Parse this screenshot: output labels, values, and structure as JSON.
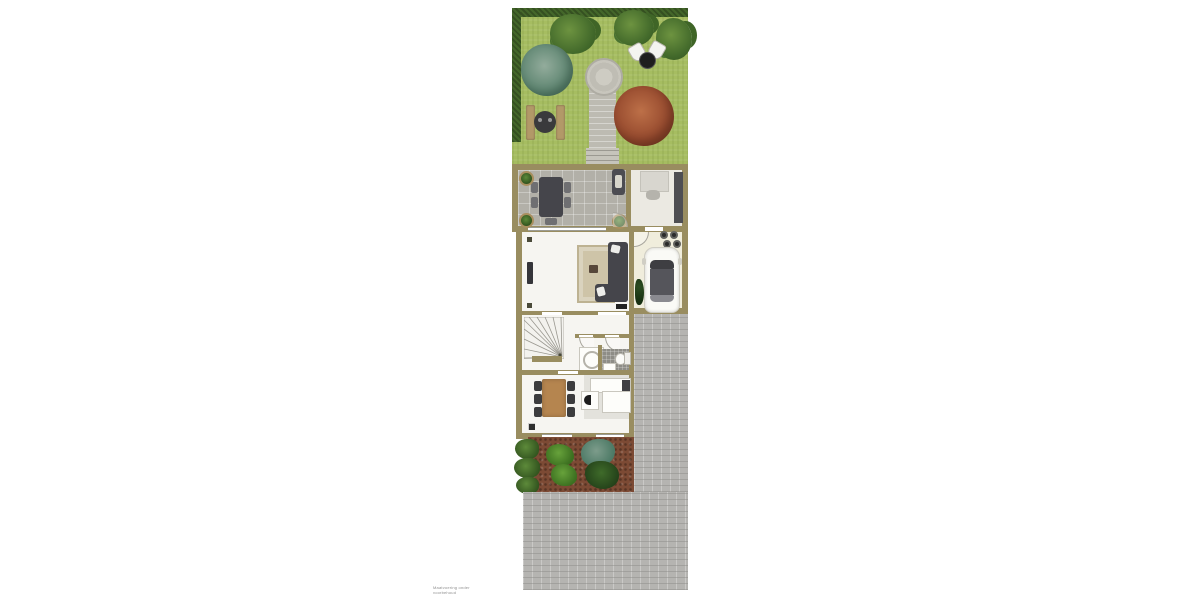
{
  "scene": {
    "type": "site-floor-plan",
    "description": "Top-down plan of a narrow lot: hedged back garden with stone path, picnic set and bistro set; house with covered terrace, office, living room, garage with parked car, stair hall, bathroom and kitchen/dining; planted border bed; paved driveway."
  },
  "watermark": {
    "text": "Maatvoering onder voorbehoud"
  },
  "palette": {
    "canvas": "#ffffff",
    "lawn": "#a6bd61",
    "hedge": "#44672a",
    "stone_path": "#bdbbb2",
    "terrace_tile": "#b2b0a8",
    "wall": "#998d60",
    "interior_floor": "#f6f5f1",
    "office_floor": "#ebe9e2",
    "garage_floor": "#f0eddc",
    "kitchen_floor": "#e3e2dc",
    "bathroom_floor": "#8e8d87",
    "rug": "#cec4a8",
    "sofa": "#45454b",
    "wood_table": "#b5854f",
    "soil": "#7c4a34",
    "paving": "#b5b4b1",
    "tree_green": "#41682a",
    "tree_teal": "#57806b",
    "tree_red": "#93472c",
    "car_body": "#fafaf6"
  },
  "objects": [
    "hedge",
    "lawn",
    "stone-path",
    "stone-circle",
    "picnic-benches",
    "picnic-table",
    "bistro-set",
    "deciduous-trees",
    "teal-tree",
    "red-maple-tree",
    "terrace-dining-table",
    "potted-plants",
    "outdoor-heater",
    "office-desk",
    "office-chair",
    "wardrobe-cabinet",
    "sofa-sectional",
    "area-rug",
    "coffee-table",
    "tv",
    "sideboard",
    "garage",
    "car",
    "cooktop-circles",
    "winder-staircase",
    "shower",
    "toilet",
    "wash-basin",
    "dining-table",
    "dining-chairs",
    "kitchen-counter",
    "fridge",
    "kitchen-sink",
    "flower-bed",
    "shrubs",
    "paved-driveway"
  ]
}
